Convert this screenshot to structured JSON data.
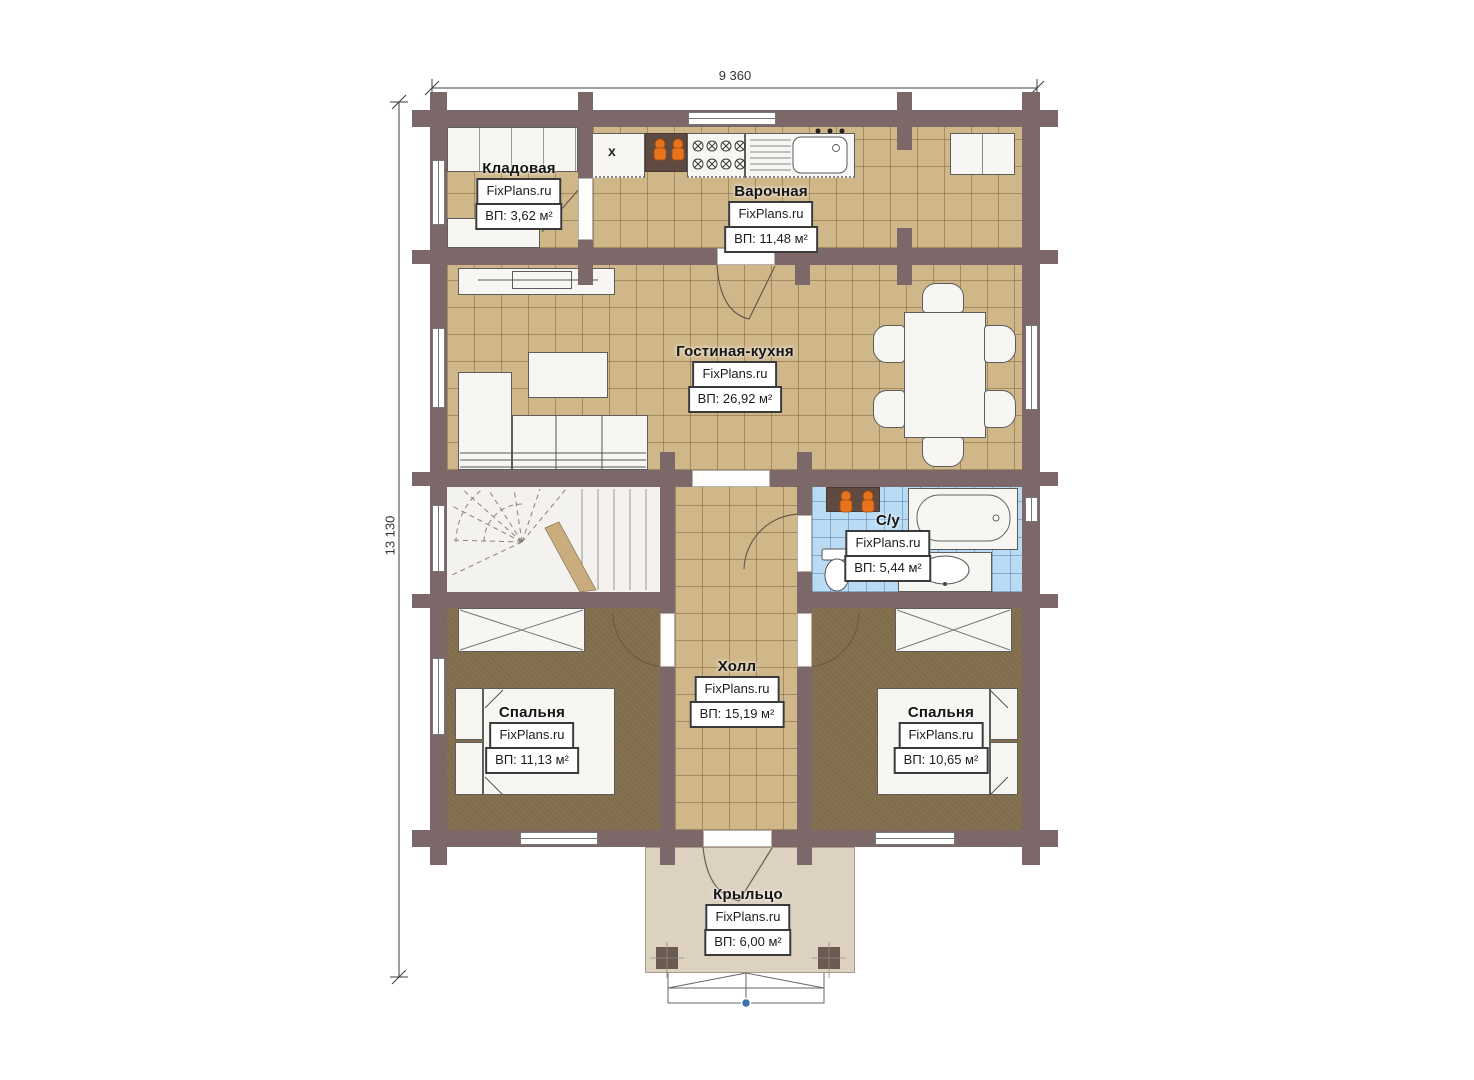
{
  "plan": {
    "watermark": "FixPlans.ru",
    "dim_top": "9 360",
    "dim_left": "13 130",
    "boiler_mark": "x",
    "rooms": [
      {
        "name": "Кладовая",
        "area": "ВП: 3,62 м²"
      },
      {
        "name": "Варочная",
        "area": "ВП: 11,48 м²"
      },
      {
        "name": "Гостиная-кухня",
        "area": "ВП: 26,92 м²"
      },
      {
        "name": "С/у",
        "area": "ВП: 5,44 м²"
      },
      {
        "name": "Холл",
        "area": "ВП: 15,19 м²"
      },
      {
        "name": "Спальня",
        "area": "ВП: 11,13 м²"
      },
      {
        "name": "Спальня",
        "area": "ВП: 10,65 м²"
      },
      {
        "name": "Крыльцо",
        "area": "ВП: 6,00 м²"
      }
    ],
    "colors": {
      "wall": "#7c6868",
      "tile_floor": "#cfb78a",
      "bedroom_floor": "#867250",
      "bathroom_tile": "#b9dbf4",
      "porch_floor": "#ddd1bf",
      "fixture_orange": "#e8731d",
      "stair_floor": "#f3f2ef"
    }
  }
}
